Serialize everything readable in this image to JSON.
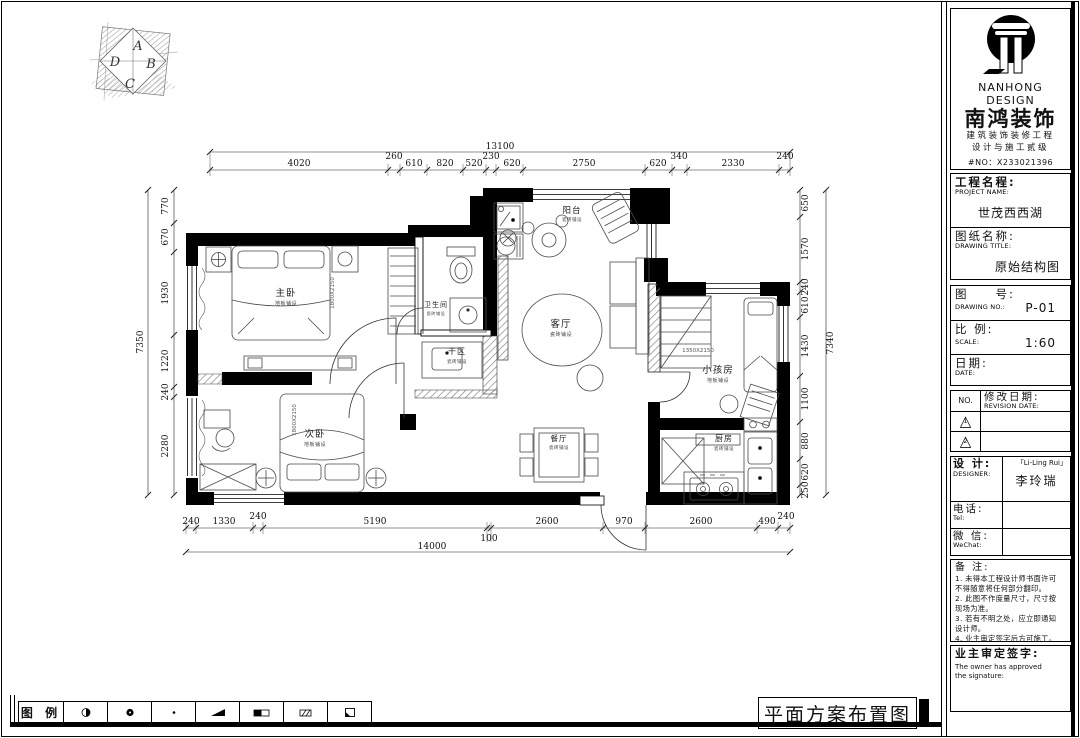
{
  "sheet": {
    "plan_title": "平面方案布置图"
  },
  "compass": {
    "letters": [
      "A",
      "B",
      "C",
      "D"
    ]
  },
  "legend": {
    "label": "图 例",
    "items": [
      {
        "name": "half-filled-circle"
      },
      {
        "name": "filled-circle"
      },
      {
        "name": "dot"
      },
      {
        "name": "filled-wedge"
      },
      {
        "name": "half-filled-bar"
      },
      {
        "name": "hatched-box"
      },
      {
        "name": "corner-filled-box"
      }
    ]
  },
  "rooms": [
    {
      "name": "主卧",
      "floor": "地板铺设"
    },
    {
      "name": "次卧",
      "floor": "地板铺设"
    },
    {
      "name": "小孩房",
      "floor": "地板铺设"
    },
    {
      "name": "客厅",
      "floor": "瓷砖铺设"
    },
    {
      "name": "餐厅",
      "floor": "瓷砖铺设"
    },
    {
      "name": "厨房",
      "floor": "瓷砖铺设"
    },
    {
      "name": "阳台",
      "floor": "瓷砖铺设"
    },
    {
      "name": "卫生间",
      "floor": "瓷砖铺设"
    },
    {
      "name": "干区",
      "floor": "瓷砖铺设"
    }
  ],
  "bed_labels": [
    "1800X2150",
    "1800X2150",
    "1350X2150"
  ],
  "dims": {
    "top_total": "13100",
    "top": [
      "4020",
      "260",
      "610",
      "820",
      "520",
      "230",
      "620",
      "2750",
      "620",
      "340",
      "2330",
      "240"
    ],
    "bottom_total": "14000",
    "bottom_inner": "100",
    "bottom": [
      "240",
      "1330",
      "240",
      "5190",
      "2600",
      "970",
      "2600",
      "490",
      "240"
    ],
    "left_total": "7350",
    "left": [
      "770",
      "670",
      "1930",
      "1220",
      "240",
      "2280"
    ],
    "right_total": "7340",
    "right": [
      "650",
      "1570",
      "240",
      "610",
      "1430",
      "1100",
      "880",
      "620",
      "250"
    ]
  },
  "titleblock": {
    "brand": {
      "en": "NANHONG DESIGN",
      "cn": "南鸿装饰",
      "line1": "建筑装饰装修工程",
      "line2": "设计与施工贰级",
      "no": "#NO：X233021396"
    },
    "project": {
      "label": "工程名程:",
      "sublabel": "PROJECT NAME:",
      "value": "世茂西西湖"
    },
    "drawing": {
      "label": "图纸名称:",
      "sublabel": "DRAWING TITLE:",
      "value": "原始结构图"
    },
    "number": {
      "label": "图　　号:",
      "sublabel": "DRAWING NO.:",
      "value": "P-01"
    },
    "scale": {
      "label": "比  例:",
      "sublabel": "SCALE:",
      "value": "1:60"
    },
    "date": {
      "label": "日期:",
      "sublabel": "DATE:",
      "value": ""
    },
    "revision": {
      "no_label": "NO.",
      "label": "修改日期:",
      "sublabel": "REVISION DATE:",
      "rows": [
        "1",
        "2"
      ]
    },
    "designer": {
      "label": "设    计:",
      "sublabel": "DESIGNER:",
      "value_en": "「Li-Ling Rui」",
      "value_cn": "李玲瑞"
    },
    "tel": {
      "label": "电话:",
      "sublabel": "Tel:",
      "value": ""
    },
    "wechat": {
      "label": "微  信:",
      "sublabel": "WeChat:",
      "value": ""
    },
    "notes": {
      "label": "备  注:",
      "lines": [
        "1. 未得本工程设计师书面许可",
        "    不得随意将任何部分翻印。",
        "2. 此图不作度量尺寸，尺寸按",
        "    现场为准。",
        "3. 若有不明之处，应立即通知",
        "    设计师。",
        "4. 业主审定签字后方可施工。"
      ],
      "footnote": "本设计解释权归设计师所有。"
    },
    "owner": {
      "label": "业主审定签字:",
      "sub1": "The owner has approved",
      "sub2": "the signature:"
    }
  }
}
